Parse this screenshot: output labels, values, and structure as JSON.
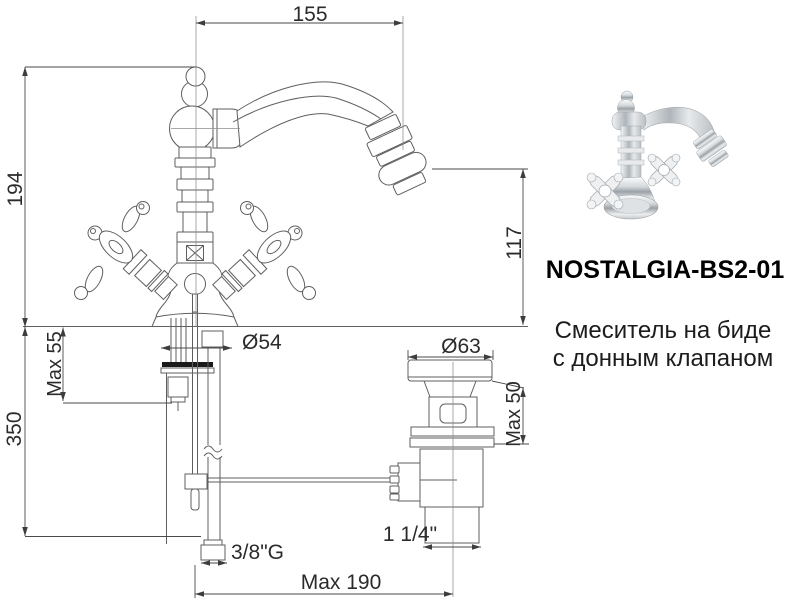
{
  "product": {
    "code": "NOSTALGIA-BS2-01",
    "description_line1": "Смеситель на биде",
    "description_line2": "с донным клапаном"
  },
  "dimensions": {
    "spout_reach": "155",
    "body_height": "194",
    "spout_height": "117",
    "base_diameter": "Ø54",
    "max_mount_thickness": "Max 55",
    "supply_length": "350",
    "supply_thread": "3/8\"G",
    "max_horizontal_reach": "Max 190",
    "drain_thread": "1 1/4\"",
    "drain_flange_diameter": "Ø63",
    "drain_max_thickness": "Max 50"
  },
  "colors": {
    "drawing_lines": "#5f5f5f",
    "dimension_lines": "#4a4a4a",
    "dimension_text": "#2b2b2b",
    "product_text": "#000000",
    "background": "#ffffff"
  }
}
